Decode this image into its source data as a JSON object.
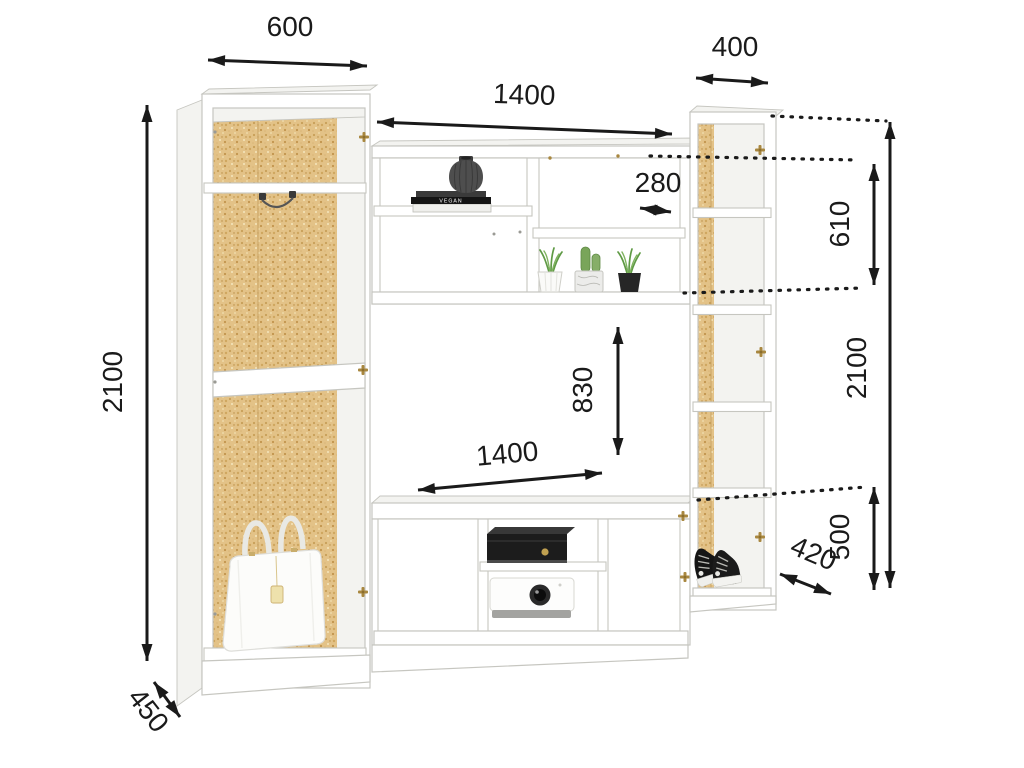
{
  "dims": {
    "left_width": "600",
    "left_height": "2100",
    "left_depth": "450",
    "top_width": "1400",
    "top_shelf": "280",
    "top_height": "610",
    "right_width": "400",
    "right_height": "2100",
    "right_depth": "420",
    "shoe_height": "500",
    "niche_height": "830",
    "base_width": "1400"
  },
  "decor": {
    "book_spine_text": "VEGAN"
  },
  "colors": {
    "outline": "#1a1a1a",
    "edge": "#c6c6c0",
    "panel": "#ffffff",
    "shade": "#f3f3f0",
    "cork": "#e3c287",
    "brass": "#a8873f",
    "plant": "#5f9a45"
  }
}
